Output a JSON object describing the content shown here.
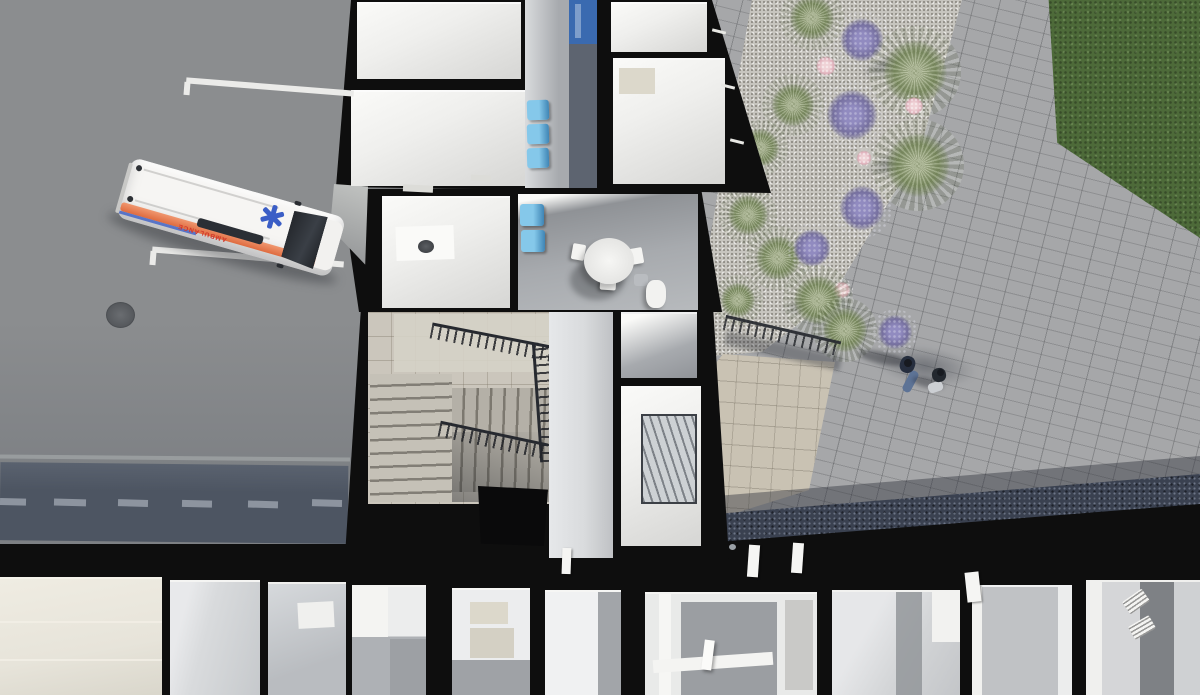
{
  "scene": {
    "title": "Aerial cutaway render of clinic building",
    "description": "Top-down 3D architectural visualization: parking lot with ambulance, cutaway floor plan with corridors, waiting chairs, round table, staircase and elevator shaft, landscaped gravel bed with grasses, lavender and pink flowers, paver walkway with two pedestrians, entrance plaza, lawn"
  },
  "ambulance": {
    "label": "AMBULANCE"
  },
  "colors": {
    "asphalt": "#8b8d8f",
    "asphalt_dark": "#7d8084",
    "curb_light": "#9fa2a4",
    "canopy": "#4d5562",
    "canopy_dash": "#99a0aa",
    "wall_black": "#0e0e0e",
    "room_white": "#efefed",
    "wall_white": "#fafaf8",
    "room_shade": "#d8d8d6",
    "floor_gray": "#a7aaae",
    "floor_gray_dark": "#8f9296",
    "floor_light": "#d9dbdd",
    "floor_beige": "#e7e4da",
    "counter_beige": "#dcd8cb",
    "tile_floor": "#cbc6bc",
    "plaza_tile": "#c9c2b3",
    "paver": "#a6a7a9",
    "paver_shade": "#75787d",
    "gravel_dark": "#3a4150",
    "gravel_light": "#c7c5bf",
    "grass": "#4d6a39",
    "plant_green": "#7e8e63",
    "plant_green_light": "#aeb896",
    "plant_purple": "#76709f",
    "plant_purple_light": "#918bc0",
    "plant_pink": "#dfafba",
    "plant_pink_light": "#efd2d6",
    "chair_blue": "#62aede",
    "chair_blue_dark": "#3f85b5",
    "cabinet_blue": "#3a6ab0",
    "amb_white": "#f6f5f3",
    "amb_stripe": "#e8896a",
    "amb_stripe_dark": "#df6b3f",
    "amb_red": "#d2372b",
    "star_blue": "#3b5ec6",
    "glass_dark": "#2b2f35",
    "railing_dark": "#26292f",
    "step_dark": "#827e76",
    "person_navy": "#262e3e",
    "person_jeans": "#5d7396",
    "person_dark": "#171a20",
    "white_line": "#ebebe9",
    "manhole": "#6a6d71"
  }
}
